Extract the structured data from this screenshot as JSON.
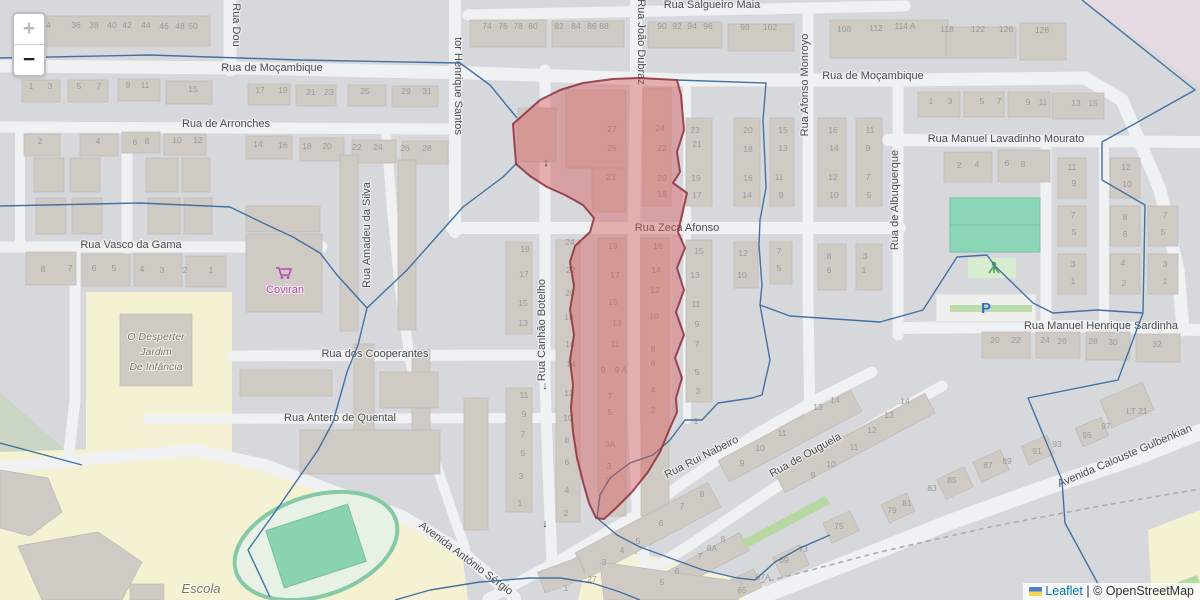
{
  "controls": {
    "zoom_in": "+",
    "zoom_out": "−"
  },
  "attribution": {
    "leaflet_label": "Leaflet",
    "separator": " | ",
    "osm_label": "© OpenStreetMap"
  },
  "colors": {
    "highlight": "#d95454",
    "highlight_stroke": "#8e2f3e",
    "boundary": "#3a6da0",
    "street_label": "#4d4d4d",
    "house_number": "#9a9a9a",
    "shop": "#b44bb0",
    "education_label": "#7d7760",
    "parking_blue": "#3b6ad1",
    "leaflet_link": "#0078a8"
  },
  "map": {
    "street_labels": [
      {
        "t": "Rua Salgueiro Maia",
        "x": 712,
        "y": 8
      },
      {
        "t": "Rua de Moçambique",
        "x": 272,
        "y": 71
      },
      {
        "t": "Rua de Moçambique",
        "x": 873,
        "y": 79
      },
      {
        "t": "Rua de Arronches",
        "x": 226,
        "y": 127
      },
      {
        "t": "Rua Manuel Lavadinho Mourato",
        "x": 1006,
        "y": 142
      },
      {
        "t": "Rua Vasco da Gama",
        "x": 131,
        "y": 248
      },
      {
        "t": "Rua Zeca Afonso",
        "x": 677,
        "y": 231
      },
      {
        "t": "Rua Manuel Henrique Sardinha",
        "x": 1101,
        "y": 329
      },
      {
        "t": "Rua dos Cooperantes",
        "x": 375,
        "y": 357
      },
      {
        "t": "Rua Antero de Quental",
        "x": 340,
        "y": 421
      },
      {
        "t": "Avenida António Sérgio",
        "x": 464,
        "y": 561,
        "r": 37
      },
      {
        "t": "Rua Rui Nabeiro",
        "x": 703,
        "y": 460,
        "r": -27
      },
      {
        "t": "Rua de Ouguela",
        "x": 807,
        "y": 458,
        "r": -29
      },
      {
        "t": "Avenida Calouste Gulbenkian",
        "x": 1126,
        "y": 459,
        "r": -23
      },
      {
        "t": "Rua Dou",
        "x": 233,
        "y": 25,
        "r": 90
      },
      {
        "t": "tor Henrique Santos",
        "x": 455,
        "y": 86,
        "r": 90
      },
      {
        "t": "Rua João Dubraz",
        "x": 638,
        "y": 42,
        "r": 90
      },
      {
        "t": "Rua Amadeu da Silva",
        "x": 370,
        "y": 235,
        "r": -90
      },
      {
        "t": "Rua Canhão Botelho",
        "x": 545,
        "y": 330,
        "r": -90
      },
      {
        "t": "Rua Afonso Monroyo",
        "x": 808,
        "y": 85,
        "r": -90
      },
      {
        "t": "Rua de Albuquerque",
        "x": 898,
        "y": 200,
        "r": -90
      }
    ],
    "poi_labels": [
      {
        "t": "Coviran",
        "x": 285,
        "y": 293,
        "cls": "shop"
      },
      {
        "t": "O Desperter",
        "x": 156,
        "y": 340,
        "cls": "edu"
      },
      {
        "t": "Jardim",
        "x": 156,
        "y": 355,
        "cls": "edu"
      },
      {
        "t": "De Infância",
        "x": 156,
        "y": 370,
        "cls": "edu"
      },
      {
        "t": "Escola",
        "x": 201,
        "y": 593,
        "cls": "edu",
        "s": 13
      },
      {
        "t": "P",
        "x": 986,
        "y": 313,
        "cls": "parking"
      }
    ],
    "oneway_arrows": [
      {
        "t": "↓",
        "x": 546,
        "y": 166
      },
      {
        "t": "↓",
        "x": 545,
        "y": 389
      },
      {
        "t": "↓",
        "x": 545,
        "y": 527
      }
    ],
    "house_numbers": [
      {
        "t": "34",
        "x": 46,
        "y": 28
      },
      {
        "t": "36",
        "x": 76,
        "y": 28
      },
      {
        "t": "38",
        "x": 94,
        "y": 28
      },
      {
        "t": "40",
        "x": 112,
        "y": 28
      },
      {
        "t": "42",
        "x": 127,
        "y": 28
      },
      {
        "t": "44",
        "x": 146,
        "y": 28
      },
      {
        "t": "46",
        "x": 164,
        "y": 29
      },
      {
        "t": "48",
        "x": 180,
        "y": 29
      },
      {
        "t": "50",
        "x": 193,
        "y": 29
      },
      {
        "t": "74",
        "x": 487,
        "y": 29
      },
      {
        "t": "76",
        "x": 503,
        "y": 29
      },
      {
        "t": "78",
        "x": 518,
        "y": 29
      },
      {
        "t": "80",
        "x": 533,
        "y": 29
      },
      {
        "t": "82",
        "x": 559,
        "y": 29
      },
      {
        "t": "84",
        "x": 576,
        "y": 29
      },
      {
        "t": "86",
        "x": 592,
        "y": 29
      },
      {
        "t": "88",
        "x": 604,
        "y": 29
      },
      {
        "t": "90",
        "x": 662,
        "y": 29
      },
      {
        "t": "92",
        "x": 677,
        "y": 29
      },
      {
        "t": "94",
        "x": 692,
        "y": 29
      },
      {
        "t": "96",
        "x": 708,
        "y": 29
      },
      {
        "t": "98",
        "x": 745,
        "y": 30
      },
      {
        "t": "102",
        "x": 770,
        "y": 30
      },
      {
        "t": "108",
        "x": 844,
        "y": 32
      },
      {
        "t": "112",
        "x": 876,
        "y": 31
      },
      {
        "t": "114 A",
        "x": 905,
        "y": 29
      },
      {
        "t": "118",
        "x": 947,
        "y": 32
      },
      {
        "t": "122",
        "x": 978,
        "y": 32
      },
      {
        "t": "126",
        "x": 1006,
        "y": 32
      },
      {
        "t": "128",
        "x": 1042,
        "y": 33
      },
      {
        "t": "1",
        "x": 31,
        "y": 89
      },
      {
        "t": "3",
        "x": 50,
        "y": 89
      },
      {
        "t": "5",
        "x": 79,
        "y": 89
      },
      {
        "t": "7",
        "x": 99,
        "y": 89
      },
      {
        "t": "9",
        "x": 128,
        "y": 88
      },
      {
        "t": "11",
        "x": 145,
        "y": 88
      },
      {
        "t": "15",
        "x": 193,
        "y": 92
      },
      {
        "t": "17",
        "x": 260,
        "y": 93
      },
      {
        "t": "19",
        "x": 283,
        "y": 93
      },
      {
        "t": "21",
        "x": 311,
        "y": 95
      },
      {
        "t": "23",
        "x": 329,
        "y": 95
      },
      {
        "t": "25",
        "x": 365,
        "y": 94
      },
      {
        "t": "29",
        "x": 406,
        "y": 94
      },
      {
        "t": "31",
        "x": 427,
        "y": 94
      },
      {
        "t": "2",
        "x": 40,
        "y": 144
      },
      {
        "t": "4",
        "x": 98,
        "y": 144
      },
      {
        "t": "6",
        "x": 135,
        "y": 145
      },
      {
        "t": "8",
        "x": 147,
        "y": 144
      },
      {
        "t": "10",
        "x": 177,
        "y": 143
      },
      {
        "t": "12",
        "x": 198,
        "y": 143
      },
      {
        "t": "14",
        "x": 258,
        "y": 147
      },
      {
        "t": "16",
        "x": 283,
        "y": 148
      },
      {
        "t": "18",
        "x": 307,
        "y": 149
      },
      {
        "t": "20",
        "x": 327,
        "y": 149
      },
      {
        "t": "22",
        "x": 357,
        "y": 150
      },
      {
        "t": "24",
        "x": 378,
        "y": 150
      },
      {
        "t": "26",
        "x": 405,
        "y": 151
      },
      {
        "t": "28",
        "x": 427,
        "y": 151
      },
      {
        "t": "1",
        "x": 931,
        "y": 104
      },
      {
        "t": "3",
        "x": 950,
        "y": 104
      },
      {
        "t": "5",
        "x": 982,
        "y": 104
      },
      {
        "t": "7",
        "x": 999,
        "y": 104
      },
      {
        "t": "9",
        "x": 1028,
        "y": 105
      },
      {
        "t": "11",
        "x": 1043,
        "y": 105
      },
      {
        "t": "13",
        "x": 1076,
        "y": 106
      },
      {
        "t": "15",
        "x": 1093,
        "y": 106
      },
      {
        "t": "8",
        "x": 43,
        "y": 272
      },
      {
        "t": "7",
        "x": 70,
        "y": 271
      },
      {
        "t": "6",
        "x": 94,
        "y": 271
      },
      {
        "t": "5",
        "x": 114,
        "y": 271
      },
      {
        "t": "4",
        "x": 142,
        "y": 272
      },
      {
        "t": "3",
        "x": 162,
        "y": 273
      },
      {
        "t": "2",
        "x": 185,
        "y": 273
      },
      {
        "t": "1",
        "x": 211,
        "y": 273
      },
      {
        "t": "27",
        "x": 612,
        "y": 132
      },
      {
        "t": "25",
        "x": 612,
        "y": 151
      },
      {
        "t": "23",
        "x": 611,
        "y": 180
      },
      {
        "t": "24",
        "x": 660,
        "y": 131
      },
      {
        "t": "22",
        "x": 662,
        "y": 151
      },
      {
        "t": "20",
        "x": 662,
        "y": 181
      },
      {
        "t": "18",
        "x": 662,
        "y": 197
      },
      {
        "t": "23",
        "x": 695,
        "y": 133
      },
      {
        "t": "21",
        "x": 697,
        "y": 147
      },
      {
        "t": "19",
        "x": 696,
        "y": 181
      },
      {
        "t": "17",
        "x": 697,
        "y": 198
      },
      {
        "t": "20",
        "x": 748,
        "y": 133
      },
      {
        "t": "18",
        "x": 748,
        "y": 152
      },
      {
        "t": "16",
        "x": 748,
        "y": 181
      },
      {
        "t": "14",
        "x": 747,
        "y": 198
      },
      {
        "t": "15",
        "x": 783,
        "y": 133
      },
      {
        "t": "13",
        "x": 783,
        "y": 151
      },
      {
        "t": "11",
        "x": 779,
        "y": 180
      },
      {
        "t": "9",
        "x": 781,
        "y": 198
      },
      {
        "t": "16",
        "x": 833,
        "y": 133
      },
      {
        "t": "14",
        "x": 834,
        "y": 151
      },
      {
        "t": "12",
        "x": 833,
        "y": 180
      },
      {
        "t": "10",
        "x": 834,
        "y": 198
      },
      {
        "t": "11",
        "x": 870,
        "y": 133
      },
      {
        "t": "9",
        "x": 868,
        "y": 151
      },
      {
        "t": "7",
        "x": 868,
        "y": 180
      },
      {
        "t": "5",
        "x": 869,
        "y": 198
      },
      {
        "t": "2",
        "x": 959,
        "y": 168
      },
      {
        "t": "4",
        "x": 977,
        "y": 167
      },
      {
        "t": "6",
        "x": 1007,
        "y": 166
      },
      {
        "t": "8",
        "x": 1023,
        "y": 167
      },
      {
        "t": "11",
        "x": 1072,
        "y": 170
      },
      {
        "t": "9",
        "x": 1074,
        "y": 186
      },
      {
        "t": "7",
        "x": 1073,
        "y": 218
      },
      {
        "t": "5",
        "x": 1074,
        "y": 235
      },
      {
        "t": "3",
        "x": 1073,
        "y": 267
      },
      {
        "t": "1",
        "x": 1073,
        "y": 284
      },
      {
        "t": "12",
        "x": 1126,
        "y": 170
      },
      {
        "t": "10",
        "x": 1127,
        "y": 187
      },
      {
        "t": "8",
        "x": 1125,
        "y": 220
      },
      {
        "t": "6",
        "x": 1125,
        "y": 237
      },
      {
        "t": "4",
        "x": 1123,
        "y": 266
      },
      {
        "t": "2",
        "x": 1124,
        "y": 286
      },
      {
        "t": "7",
        "x": 1165,
        "y": 218
      },
      {
        "t": "5",
        "x": 1163,
        "y": 235
      },
      {
        "t": "3",
        "x": 1165,
        "y": 267
      },
      {
        "t": "1",
        "x": 1165,
        "y": 284
      },
      {
        "t": "15",
        "x": 699,
        "y": 254
      },
      {
        "t": "13",
        "x": 695,
        "y": 278
      },
      {
        "t": "11",
        "x": 696,
        "y": 307
      },
      {
        "t": "9",
        "x": 697,
        "y": 327
      },
      {
        "t": "7",
        "x": 697,
        "y": 347
      },
      {
        "t": "5",
        "x": 697,
        "y": 375
      },
      {
        "t": "3",
        "x": 698,
        "y": 394
      },
      {
        "t": "1",
        "x": 696,
        "y": 424
      },
      {
        "t": "12",
        "x": 743,
        "y": 256
      },
      {
        "t": "10",
        "x": 742,
        "y": 278
      },
      {
        "t": "7",
        "x": 779,
        "y": 254
      },
      {
        "t": "5",
        "x": 779,
        "y": 271
      },
      {
        "t": "8",
        "x": 829,
        "y": 259
      },
      {
        "t": "6",
        "x": 829,
        "y": 273
      },
      {
        "t": "3",
        "x": 865,
        "y": 259
      },
      {
        "t": "1",
        "x": 864,
        "y": 273
      },
      {
        "t": "19",
        "x": 613,
        "y": 249
      },
      {
        "t": "17",
        "x": 615,
        "y": 278
      },
      {
        "t": "15",
        "x": 613,
        "y": 305
      },
      {
        "t": "13",
        "x": 617,
        "y": 326
      },
      {
        "t": "11",
        "x": 615,
        "y": 347
      },
      {
        "t": "9",
        "x": 603,
        "y": 373
      },
      {
        "t": "9 A",
        "x": 621,
        "y": 373
      },
      {
        "t": "7",
        "x": 610,
        "y": 399
      },
      {
        "t": "5",
        "x": 610,
        "y": 415
      },
      {
        "t": "3A",
        "x": 610,
        "y": 447
      },
      {
        "t": "3",
        "x": 609,
        "y": 469
      },
      {
        "t": "1",
        "x": 607,
        "y": 483
      },
      {
        "t": "16",
        "x": 658,
        "y": 249
      },
      {
        "t": "14",
        "x": 656,
        "y": 273
      },
      {
        "t": "12",
        "x": 655,
        "y": 293
      },
      {
        "t": "10",
        "x": 654,
        "y": 319
      },
      {
        "t": "8",
        "x": 653,
        "y": 352
      },
      {
        "t": "6",
        "x": 653,
        "y": 366
      },
      {
        "t": "4",
        "x": 653,
        "y": 393
      },
      {
        "t": "2",
        "x": 653,
        "y": 413
      },
      {
        "t": "24",
        "x": 570,
        "y": 245
      },
      {
        "t": "22",
        "x": 571,
        "y": 273
      },
      {
        "t": "20",
        "x": 570,
        "y": 296
      },
      {
        "t": "18",
        "x": 569,
        "y": 320
      },
      {
        "t": "16",
        "x": 570,
        "y": 347
      },
      {
        "t": "14",
        "x": 571,
        "y": 367
      },
      {
        "t": "12",
        "x": 569,
        "y": 396
      },
      {
        "t": "10",
        "x": 568,
        "y": 421
      },
      {
        "t": "8",
        "x": 567,
        "y": 443
      },
      {
        "t": "6",
        "x": 567,
        "y": 465
      },
      {
        "t": "4",
        "x": 567,
        "y": 493
      },
      {
        "t": "2",
        "x": 566,
        "y": 516
      },
      {
        "t": "19",
        "x": 525,
        "y": 252
      },
      {
        "t": "17",
        "x": 524,
        "y": 277
      },
      {
        "t": "15",
        "x": 523,
        "y": 306
      },
      {
        "t": "13",
        "x": 523,
        "y": 326
      },
      {
        "t": "11",
        "x": 524,
        "y": 398
      },
      {
        "t": "9",
        "x": 524,
        "y": 417
      },
      {
        "t": "7",
        "x": 523,
        "y": 437
      },
      {
        "t": "5",
        "x": 523,
        "y": 456
      },
      {
        "t": "3",
        "x": 521,
        "y": 479
      },
      {
        "t": "1",
        "x": 520,
        "y": 506
      },
      {
        "t": "20",
        "x": 995,
        "y": 343
      },
      {
        "t": "22",
        "x": 1016,
        "y": 343
      },
      {
        "t": "24",
        "x": 1045,
        "y": 343
      },
      {
        "t": "26",
        "x": 1062,
        "y": 344
      },
      {
        "t": "28",
        "x": 1093,
        "y": 344
      },
      {
        "t": "30",
        "x": 1113,
        "y": 345
      },
      {
        "t": "32",
        "x": 1157,
        "y": 347
      },
      {
        "t": "9",
        "x": 742,
        "y": 466
      },
      {
        "t": "10",
        "x": 760,
        "y": 451
      },
      {
        "t": "11",
        "x": 782,
        "y": 436
      },
      {
        "t": "13",
        "x": 818,
        "y": 410
      },
      {
        "t": "14",
        "x": 835,
        "y": 403
      },
      {
        "t": "9",
        "x": 813,
        "y": 478
      },
      {
        "t": "10",
        "x": 831,
        "y": 467
      },
      {
        "t": "11",
        "x": 854,
        "y": 450
      },
      {
        "t": "12",
        "x": 872,
        "y": 433
      },
      {
        "t": "13",
        "x": 889,
        "y": 418
      },
      {
        "t": "14",
        "x": 905,
        "y": 404
      },
      {
        "t": "8",
        "x": 702,
        "y": 497
      },
      {
        "t": "7",
        "x": 682,
        "y": 509
      },
      {
        "t": "6",
        "x": 661,
        "y": 526
      },
      {
        "t": "5",
        "x": 638,
        "y": 544
      },
      {
        "t": "4",
        "x": 622,
        "y": 553
      },
      {
        "t": "3",
        "x": 604,
        "y": 565
      },
      {
        "t": "27",
        "x": 592,
        "y": 582
      },
      {
        "t": "1",
        "x": 566,
        "y": 591
      },
      {
        "t": "8",
        "x": 723,
        "y": 542
      },
      {
        "t": "8A",
        "x": 712,
        "y": 551
      },
      {
        "t": "7",
        "x": 700,
        "y": 559
      },
      {
        "t": "6",
        "x": 677,
        "y": 574
      },
      {
        "t": "5",
        "x": 662,
        "y": 585
      },
      {
        "t": "65",
        "x": 742,
        "y": 593
      },
      {
        "t": "67A",
        "x": 763,
        "y": 580
      },
      {
        "t": "69",
        "x": 784,
        "y": 563
      },
      {
        "t": "73",
        "x": 803,
        "y": 552
      },
      {
        "t": "75",
        "x": 839,
        "y": 529
      },
      {
        "t": "79",
        "x": 892,
        "y": 513
      },
      {
        "t": "81",
        "x": 907,
        "y": 506
      },
      {
        "t": "83",
        "x": 932,
        "y": 491
      },
      {
        "t": "85",
        "x": 952,
        "y": 483
      },
      {
        "t": "87",
        "x": 988,
        "y": 468
      },
      {
        "t": "89",
        "x": 1007,
        "y": 464
      },
      {
        "t": "91",
        "x": 1037,
        "y": 454
      },
      {
        "t": "93",
        "x": 1057,
        "y": 447
      },
      {
        "t": "95",
        "x": 1087,
        "y": 438
      },
      {
        "t": "97",
        "x": 1106,
        "y": 429
      },
      {
        "t": "LT 21",
        "x": 1137,
        "y": 414
      }
    ]
  }
}
